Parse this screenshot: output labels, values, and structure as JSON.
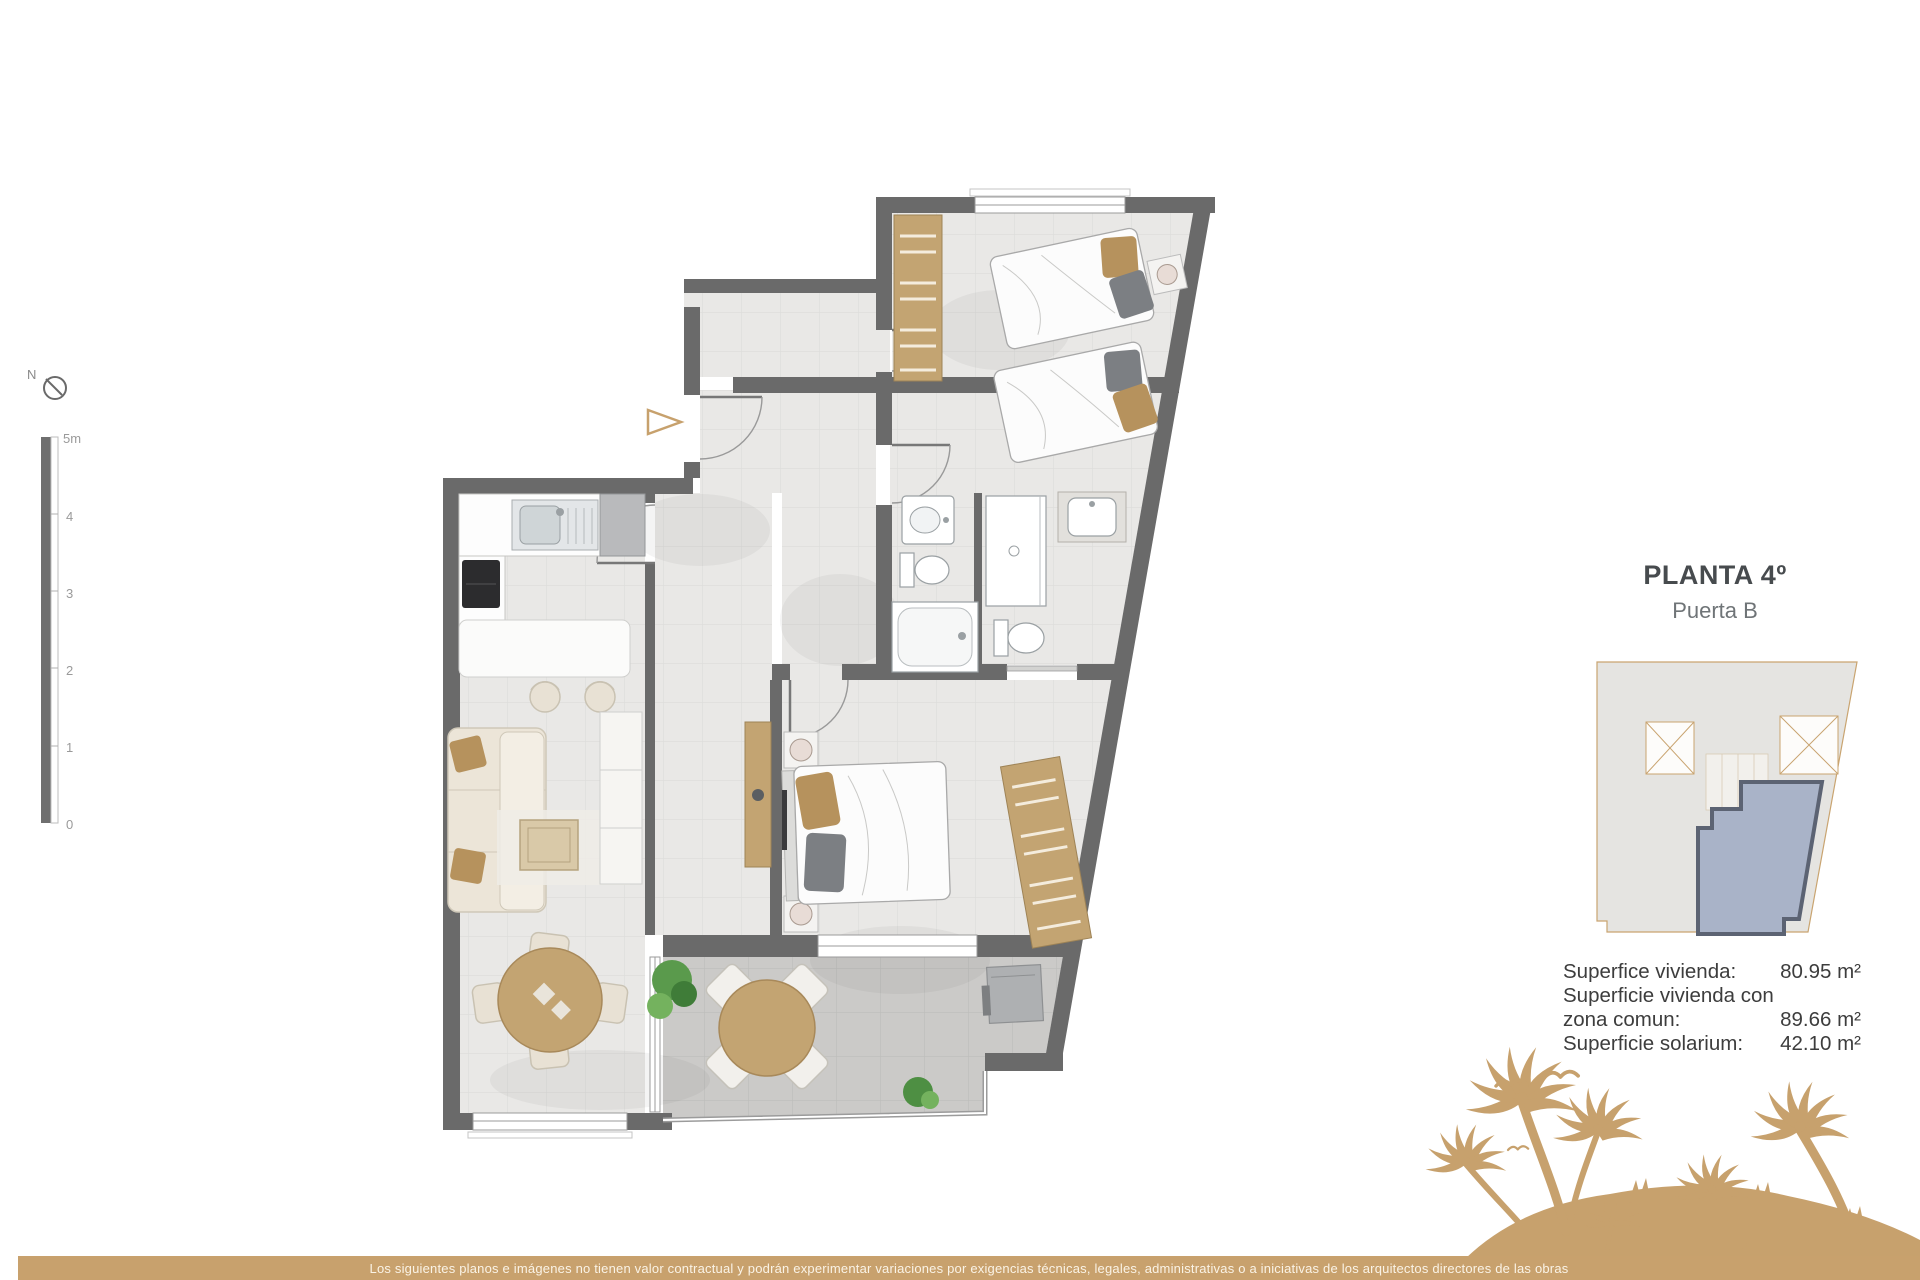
{
  "title": {
    "main": "PLANTA 4º",
    "sub": "Puerta B"
  },
  "surface_table": {
    "rows": [
      {
        "label": "Superfice vivienda:",
        "value": "80.95 m²"
      },
      {
        "label": "Superficie vivienda con",
        "value": ""
      },
      {
        "label": "zona comun:",
        "value": "89.66 m²"
      },
      {
        "label": "Superficie solarium:",
        "value": "42.10 m²"
      }
    ]
  },
  "scale_bar": {
    "unit_labels": [
      "5m",
      "4",
      "3",
      "2",
      "1",
      "0"
    ]
  },
  "compass": {
    "label": "N"
  },
  "footer": {
    "disclaimer": "Los siguientes planos e imágenes no tienen valor contractual y podrán experimentar variaciones por exigencias técnicas, legales, administrativas o a iniciativas de los arquitectos directores de las obras"
  },
  "colors": {
    "wall": "#6a6a6a",
    "floor": "#e9e8e6",
    "terrace_floor": "#cbcac8",
    "wood_tan": "#c3a472",
    "accent_tan": "#c8a16d",
    "keyplan_building": "#e5e4e1",
    "keyplan_highlight": "#a9b3c8",
    "keyplan_highlight_border": "#5c6373",
    "title_color": "#474b4e"
  },
  "icons": [
    "north-compass-icon",
    "entry-arrow-icon",
    "palm-trees-graphic",
    "seagull-icon"
  ]
}
